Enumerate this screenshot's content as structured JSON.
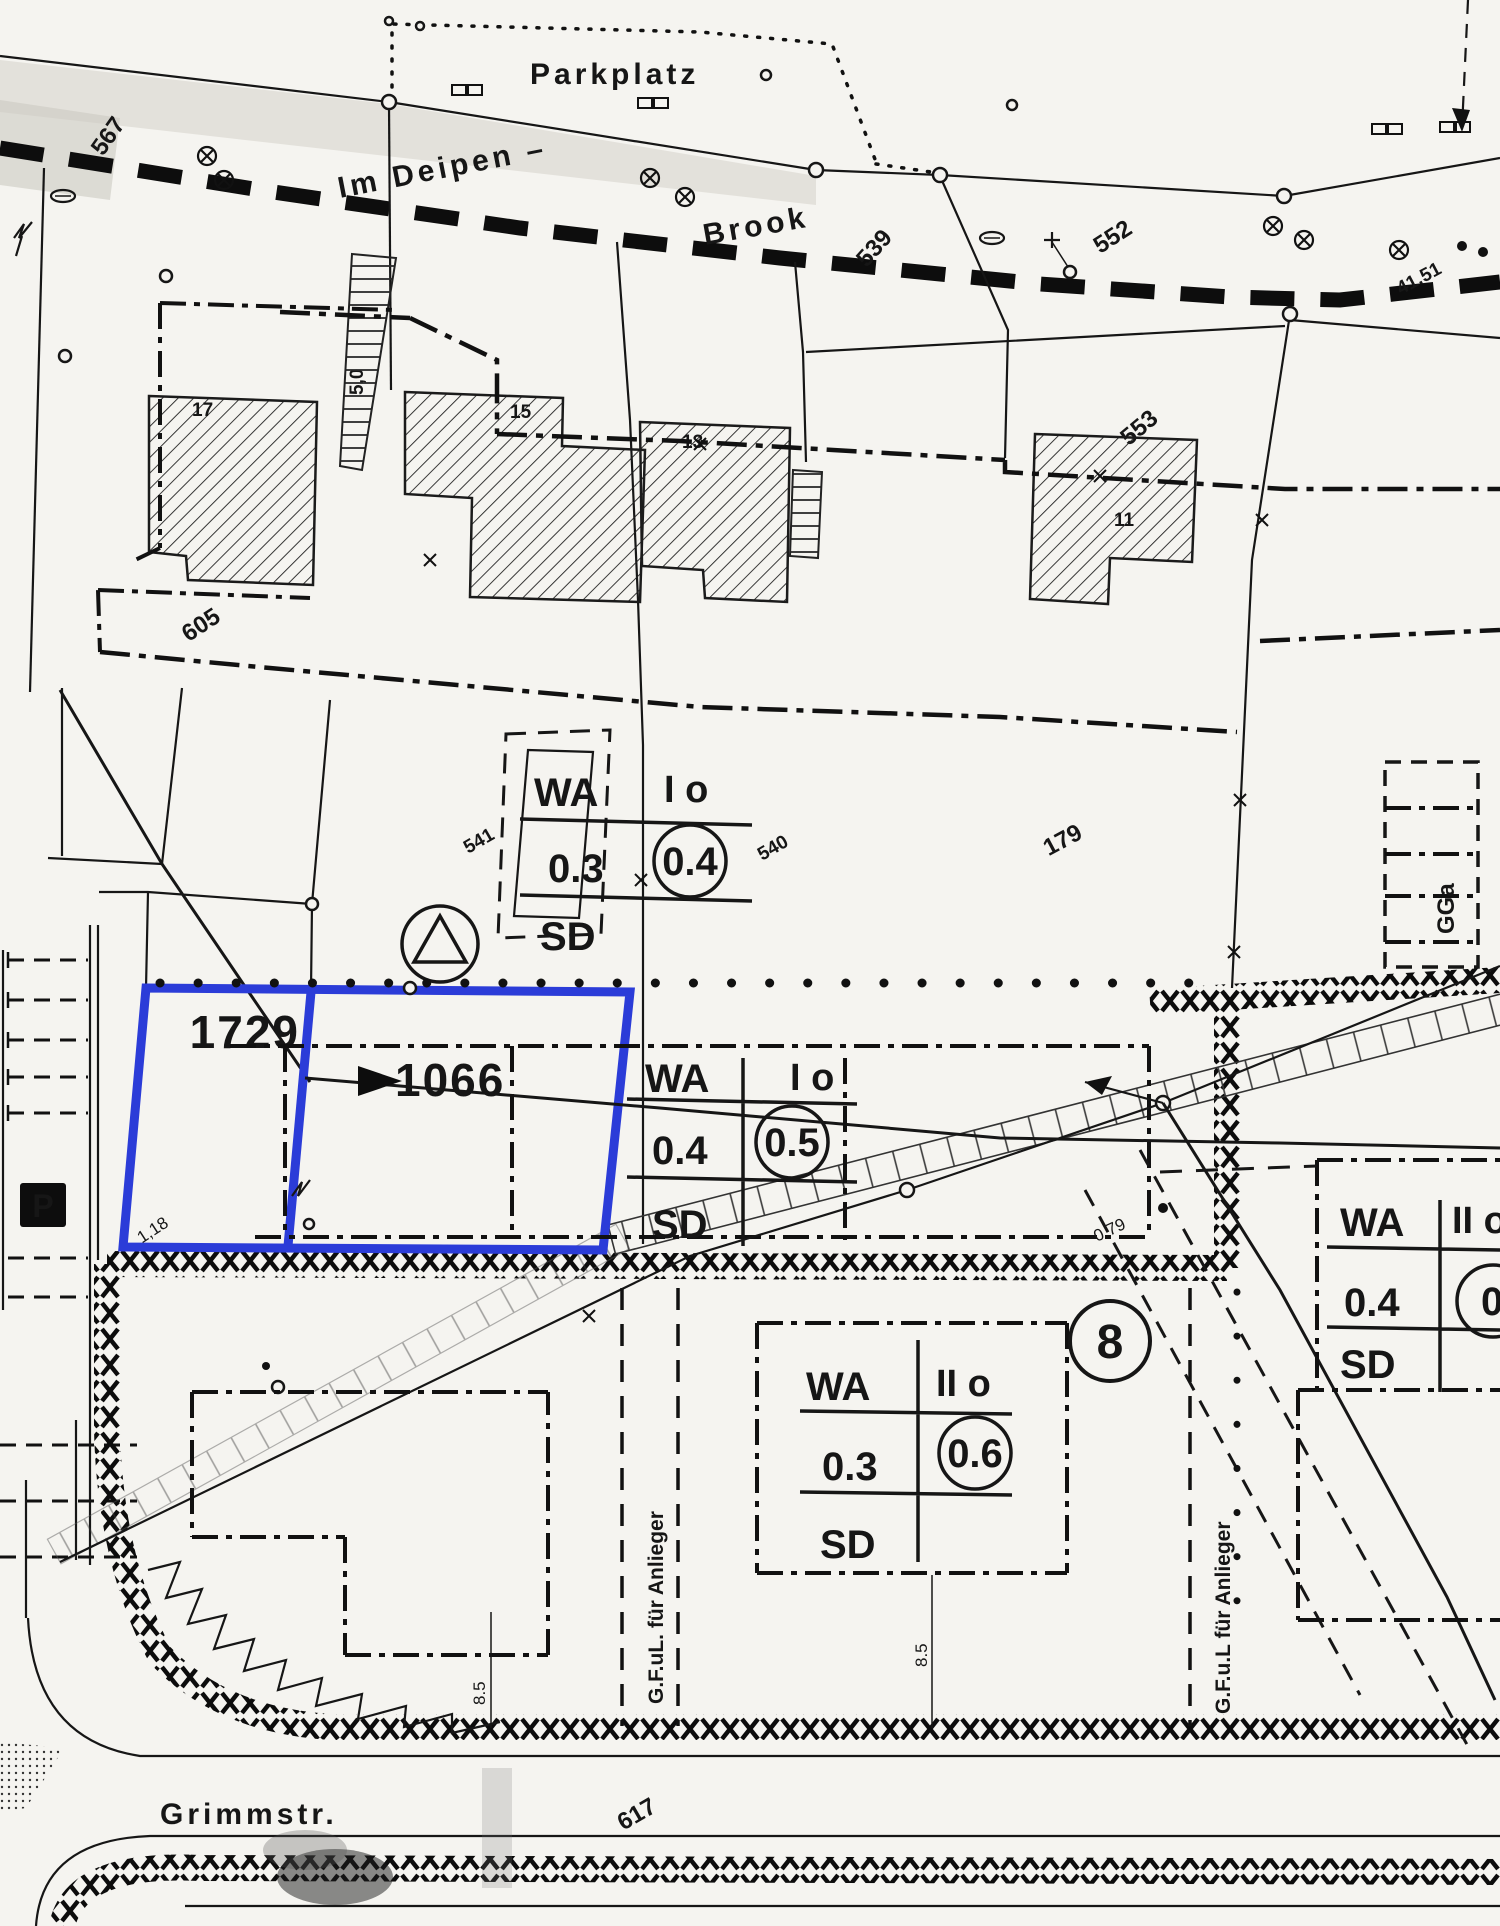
{
  "map": {
    "labels": {
      "parkplatz": "Parkplatz",
      "street_deipen": "Im Deipen –",
      "street_brook": "Brook",
      "grimmstr": "Grimmstr.",
      "p567": "567",
      "p539": "539",
      "p552": "552",
      "p553": "553",
      "p605": "605",
      "p541": "541",
      "p540": "540",
      "p179": "179",
      "p617": "617",
      "b17": "17",
      "b15": "15",
      "b13": "13",
      "b11": "11",
      "d50": "5,0",
      "d4151": "41.51",
      "d118": "1,18",
      "d079": "0.79",
      "d85a": "8.5",
      "d85b": "8.5",
      "gga": "GGa",
      "anlieger_left": "G.F.uL. für Anlieger",
      "anlieger_right": "G.F.u.L für Anlieger",
      "p_symbol": "P",
      "block8": "8"
    },
    "highlight": {
      "parcel_a": "1729",
      "parcel_b": "1066",
      "color": "#2b3cd8"
    },
    "zoning": [
      {
        "use": "WA",
        "floors": "I o",
        "grz": "0.3",
        "gfz": "0.4",
        "roof": "SD"
      },
      {
        "use": "WA",
        "floors": "I o",
        "grz": "0.4",
        "gfz": "0.5",
        "roof": "SD"
      },
      {
        "use": "WA",
        "floors": "II o",
        "grz": "0.3",
        "gfz": "0.6",
        "roof": "SD"
      },
      {
        "use": "WA",
        "floors": "II o",
        "grz": "0.4",
        "gfz": "0.5",
        "roof": "SD"
      }
    ],
    "colors": {
      "ink": "#161616",
      "paper": "#f5f4f0",
      "highlight": "#2b3cd8"
    }
  }
}
